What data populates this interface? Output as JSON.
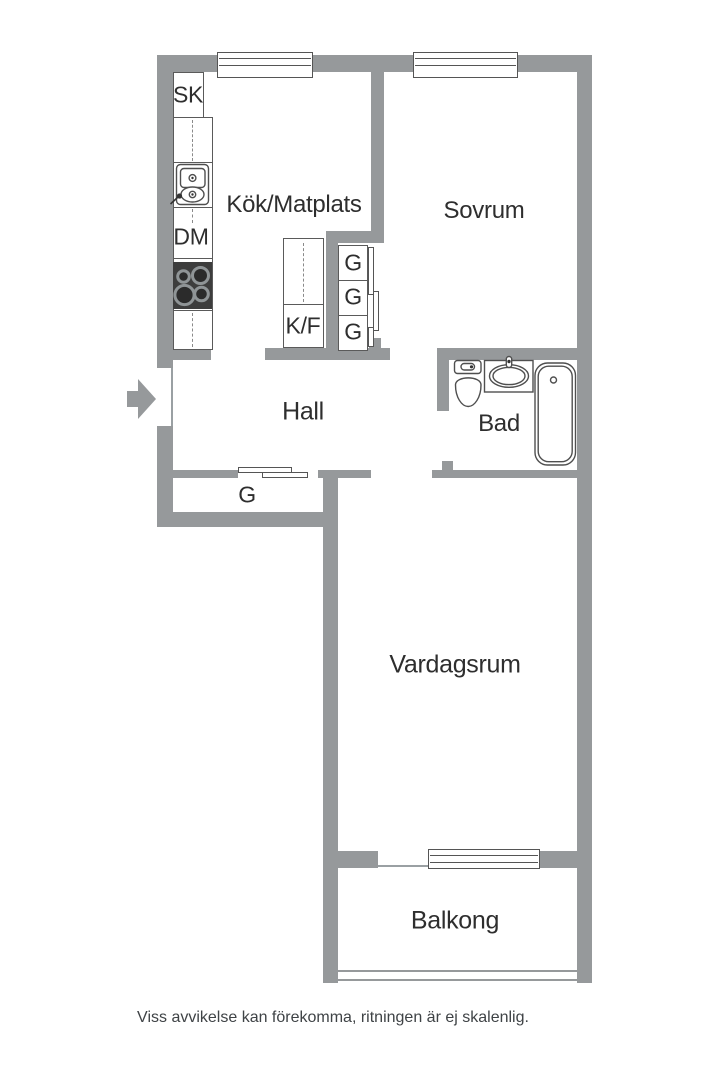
{
  "floorplan": {
    "rooms": {
      "kitchen": "Kök/Matplats",
      "bedroom": "Sovrum",
      "hall": "Hall",
      "bathroom": "Bad",
      "living_room": "Vardagsrum",
      "balcony": "Balkong"
    },
    "fixtures": {
      "tall_cabinet": "SK",
      "dishwasher": "DM",
      "fridge_freezer": "K/F",
      "bedroom_wardrobes": [
        "G",
        "G",
        "G"
      ],
      "hall_wardrobe": "G"
    },
    "disclaimer": "Viss avvikelse kan förekomma, ritningen är ej skalenlig.",
    "colors": {
      "wall": "#96999b",
      "line": "#4f4f4f",
      "text": "#2e2e2e",
      "background": "#ffffff"
    }
  }
}
